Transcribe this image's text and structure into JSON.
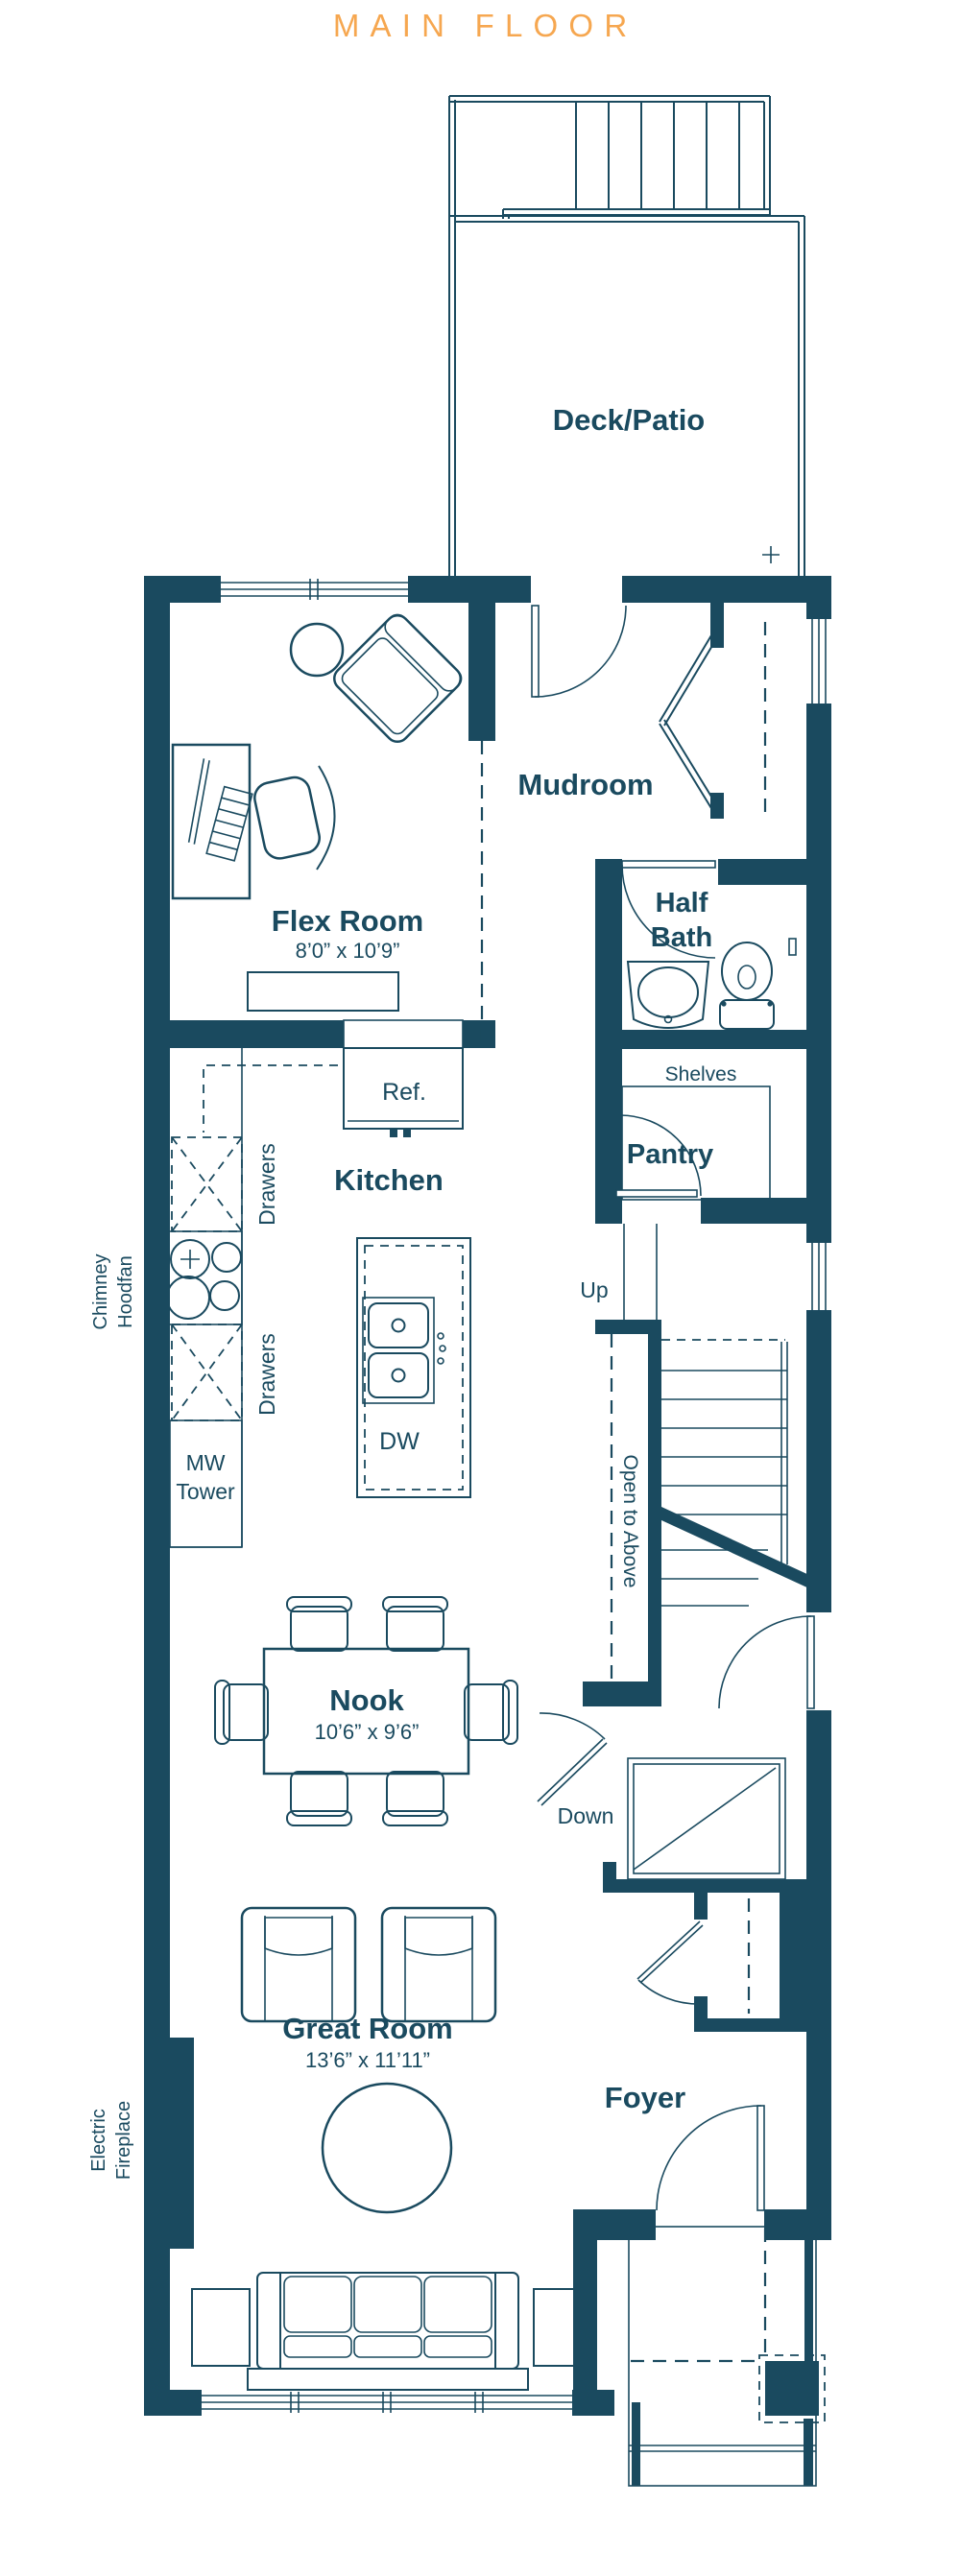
{
  "title": "MAIN FLOOR",
  "colors": {
    "accent": "#F6A750",
    "ink": "#1A4A5F"
  },
  "deck": {
    "label": "Deck/Patio"
  },
  "rooms": {
    "flex": {
      "label": "Flex Room",
      "dims": "8’0” x 10’9”"
    },
    "mudroom": {
      "label": "Mudroom"
    },
    "half_bath": {
      "line1": "Half",
      "line2": "Bath"
    },
    "pantry": {
      "label": "Pantry",
      "shelves": "Shelves"
    },
    "kitchen": {
      "label": "Kitchen",
      "fridge": "Ref.",
      "dishwasher": "DW",
      "microwave_line1": "MW",
      "microwave_line2": "Tower",
      "drawers_upper": "Drawers",
      "drawers_lower": "Drawers"
    },
    "nook": {
      "label": "Nook",
      "dims": "10’6” x 9’6”"
    },
    "great_room": {
      "label": "Great Room",
      "dims": "13’6” x 11’11”"
    },
    "foyer": {
      "label": "Foyer"
    }
  },
  "stairs": {
    "up": "Up",
    "down": "Down",
    "open_to_above": "Open to Above"
  },
  "callouts": {
    "chimney_line1": "Chimney",
    "chimney_line2": "Hoodfan",
    "fireplace_line1": "Electric",
    "fireplace_line2": "Fireplace"
  }
}
